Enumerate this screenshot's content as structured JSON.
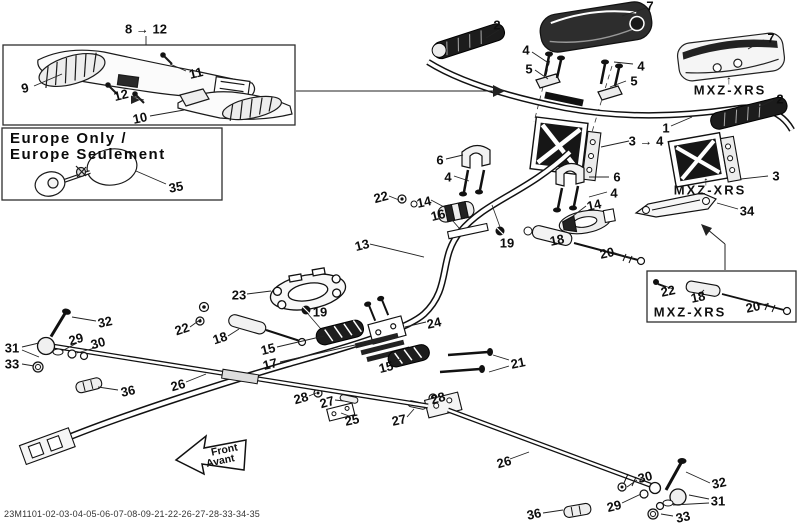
{
  "footer": {
    "part_code": "23M1101-02-03-04-05-06-07-08-09-21-22-26-27-28-33-34-35"
  },
  "colors": {
    "line": "#1a1a1a",
    "label": "#0d0d0d",
    "dark_fill": "#2d2d2d",
    "box_border": "#2e2e2e",
    "bg": "#ffffff"
  },
  "boxes": {
    "handguard": {
      "range_label": "8 → 12"
    },
    "europe": {
      "title_line1": "Europe Only /",
      "title_line2": "Europe Seulement"
    },
    "mxz_inset": {
      "label": "MXZ-XRS"
    }
  },
  "mxz_labels": {
    "pad": "MXZ-XRS",
    "riser": "MXZ-XRS",
    "inset": "MXZ-XRS"
  },
  "front_arrow": {
    "line1": "Front",
    "line2": "Avant"
  },
  "callouts": [
    {
      "t": "8 → 12",
      "x": 146,
      "y": 29
    },
    {
      "t": "9",
      "x": 25,
      "y": 88,
      "r": -12
    },
    {
      "t": "11",
      "x": 196,
      "y": 73,
      "r": -14
    },
    {
      "t": "12",
      "x": 121,
      "y": 95,
      "r": -14
    },
    {
      "t": "10",
      "x": 140,
      "y": 118,
      "r": -12
    },
    {
      "t": "35",
      "x": 176,
      "y": 187,
      "r": -10
    },
    {
      "t": "2",
      "x": 497,
      "y": 25
    },
    {
      "t": "7",
      "x": 650,
      "y": 6
    },
    {
      "t": "4",
      "x": 526,
      "y": 50
    },
    {
      "t": "5",
      "x": 529,
      "y": 69
    },
    {
      "t": "4",
      "x": 641,
      "y": 66
    },
    {
      "t": "5",
      "x": 634,
      "y": 81
    },
    {
      "t": "7",
      "x": 771,
      "y": 38
    },
    {
      "t": "↑",
      "x": 729,
      "y": 80,
      "s": 12
    },
    {
      "t": "2",
      "x": 780,
      "y": 99
    },
    {
      "t": "1",
      "x": 666,
      "y": 128
    },
    {
      "t": "3 → 4",
      "x": 646,
      "y": 141
    },
    {
      "t": "3",
      "x": 776,
      "y": 176
    },
    {
      "t": "↑",
      "x": 706,
      "y": 181,
      "s": 12
    },
    {
      "t": "34",
      "x": 747,
      "y": 211
    },
    {
      "t": "6",
      "x": 440,
      "y": 160
    },
    {
      "t": "4",
      "x": 448,
      "y": 177
    },
    {
      "t": "6",
      "x": 617,
      "y": 177
    },
    {
      "t": "4",
      "x": 614,
      "y": 193
    },
    {
      "t": "22",
      "x": 381,
      "y": 197,
      "r": -15
    },
    {
      "t": "14",
      "x": 424,
      "y": 202,
      "r": -12
    },
    {
      "t": "16",
      "x": 438,
      "y": 215,
      "r": -14
    },
    {
      "t": "13",
      "x": 362,
      "y": 245,
      "r": -14
    },
    {
      "t": "19",
      "x": 507,
      "y": 243
    },
    {
      "t": "14",
      "x": 594,
      "y": 205,
      "r": -12
    },
    {
      "t": "18",
      "x": 557,
      "y": 240,
      "r": -12
    },
    {
      "t": "20",
      "x": 607,
      "y": 253,
      "r": -12
    },
    {
      "t": "24",
      "x": 434,
      "y": 323,
      "r": -12
    },
    {
      "t": "23",
      "x": 239,
      "y": 295
    },
    {
      "t": "19",
      "x": 320,
      "y": 312
    },
    {
      "t": "22",
      "x": 182,
      "y": 329,
      "r": -18
    },
    {
      "t": "18",
      "x": 220,
      "y": 338,
      "r": -18
    },
    {
      "t": "15",
      "x": 268,
      "y": 349,
      "r": -14
    },
    {
      "t": "17",
      "x": 270,
      "y": 364,
      "r": -14
    },
    {
      "t": "15",
      "x": 386,
      "y": 367,
      "r": -14
    },
    {
      "t": "21",
      "x": 518,
      "y": 363,
      "r": -12
    },
    {
      "t": "28",
      "x": 301,
      "y": 398,
      "r": -16
    },
    {
      "t": "27",
      "x": 327,
      "y": 402,
      "r": -16
    },
    {
      "t": "25",
      "x": 352,
      "y": 420,
      "r": -12
    },
    {
      "t": "27",
      "x": 399,
      "y": 420,
      "r": -12
    },
    {
      "t": "28",
      "x": 438,
      "y": 398,
      "r": -16
    },
    {
      "t": "26",
      "x": 178,
      "y": 385,
      "r": -16
    },
    {
      "t": "26",
      "x": 504,
      "y": 462,
      "r": -16
    },
    {
      "t": "32",
      "x": 105,
      "y": 322,
      "r": -12
    },
    {
      "t": "29",
      "x": 76,
      "y": 339,
      "r": -16
    },
    {
      "t": "30",
      "x": 98,
      "y": 343,
      "r": -16
    },
    {
      "t": "31",
      "x": 12,
      "y": 348
    },
    {
      "t": "33",
      "x": 12,
      "y": 364
    },
    {
      "t": "36",
      "x": 128,
      "y": 391,
      "r": -12
    },
    {
      "t": "30",
      "x": 645,
      "y": 477,
      "r": -14
    },
    {
      "t": "32",
      "x": 719,
      "y": 483,
      "r": -12
    },
    {
      "t": "29",
      "x": 614,
      "y": 506,
      "r": -14
    },
    {
      "t": "31",
      "x": 718,
      "y": 501
    },
    {
      "t": "33",
      "x": 683,
      "y": 517,
      "r": -12
    },
    {
      "t": "36",
      "x": 534,
      "y": 514,
      "r": -12
    },
    {
      "t": "22",
      "x": 668,
      "y": 291,
      "r": -12
    },
    {
      "t": "18",
      "x": 698,
      "y": 297,
      "r": -12
    },
    {
      "t": "20",
      "x": 753,
      "y": 307,
      "r": -12
    }
  ]
}
